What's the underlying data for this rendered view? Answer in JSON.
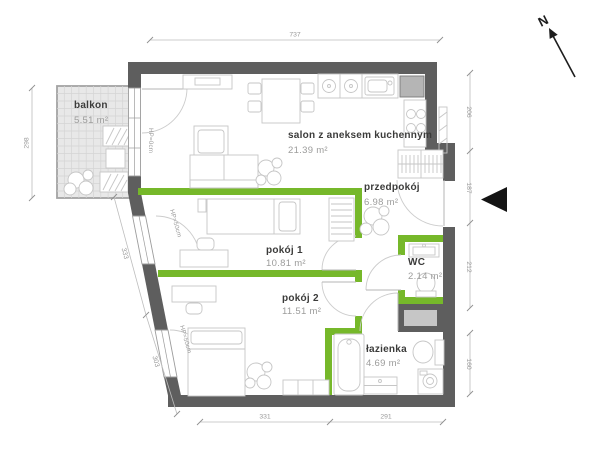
{
  "rooms": [
    {
      "name": "balkon",
      "area": "5.51 m²"
    },
    {
      "name": "salon z aneksem kuchennym",
      "area": "21.39 m²"
    },
    {
      "name": "przedpokój",
      "area": "6.98 m²"
    },
    {
      "name": "pokój 1",
      "area": "10.81 m²"
    },
    {
      "name": "pokój 2",
      "area": "11.51 m²"
    },
    {
      "name": "WC",
      "area": "2.14 m²"
    },
    {
      "name": "łazienka",
      "area": "4.69 m²"
    }
  ],
  "dimensions": {
    "top": "737",
    "balcony_left": "298",
    "slant_upper": "333",
    "slant_lower": "303",
    "right_1": "206",
    "right_2": "187",
    "right_3": "212",
    "right_4": "160",
    "bottom_left": "331",
    "bottom_right": "291"
  },
  "window_labels": {
    "balcony": "HP=0cm",
    "room1": "HP=50cm",
    "room2": "HP=50cm"
  },
  "compass": {
    "label": "N"
  },
  "colors": {
    "wall": "#5e5e5e",
    "interior_wall_accent": "#76b82a",
    "dimension_text": "#9a9a9a",
    "balcony_fill": "#e8e8e8"
  }
}
